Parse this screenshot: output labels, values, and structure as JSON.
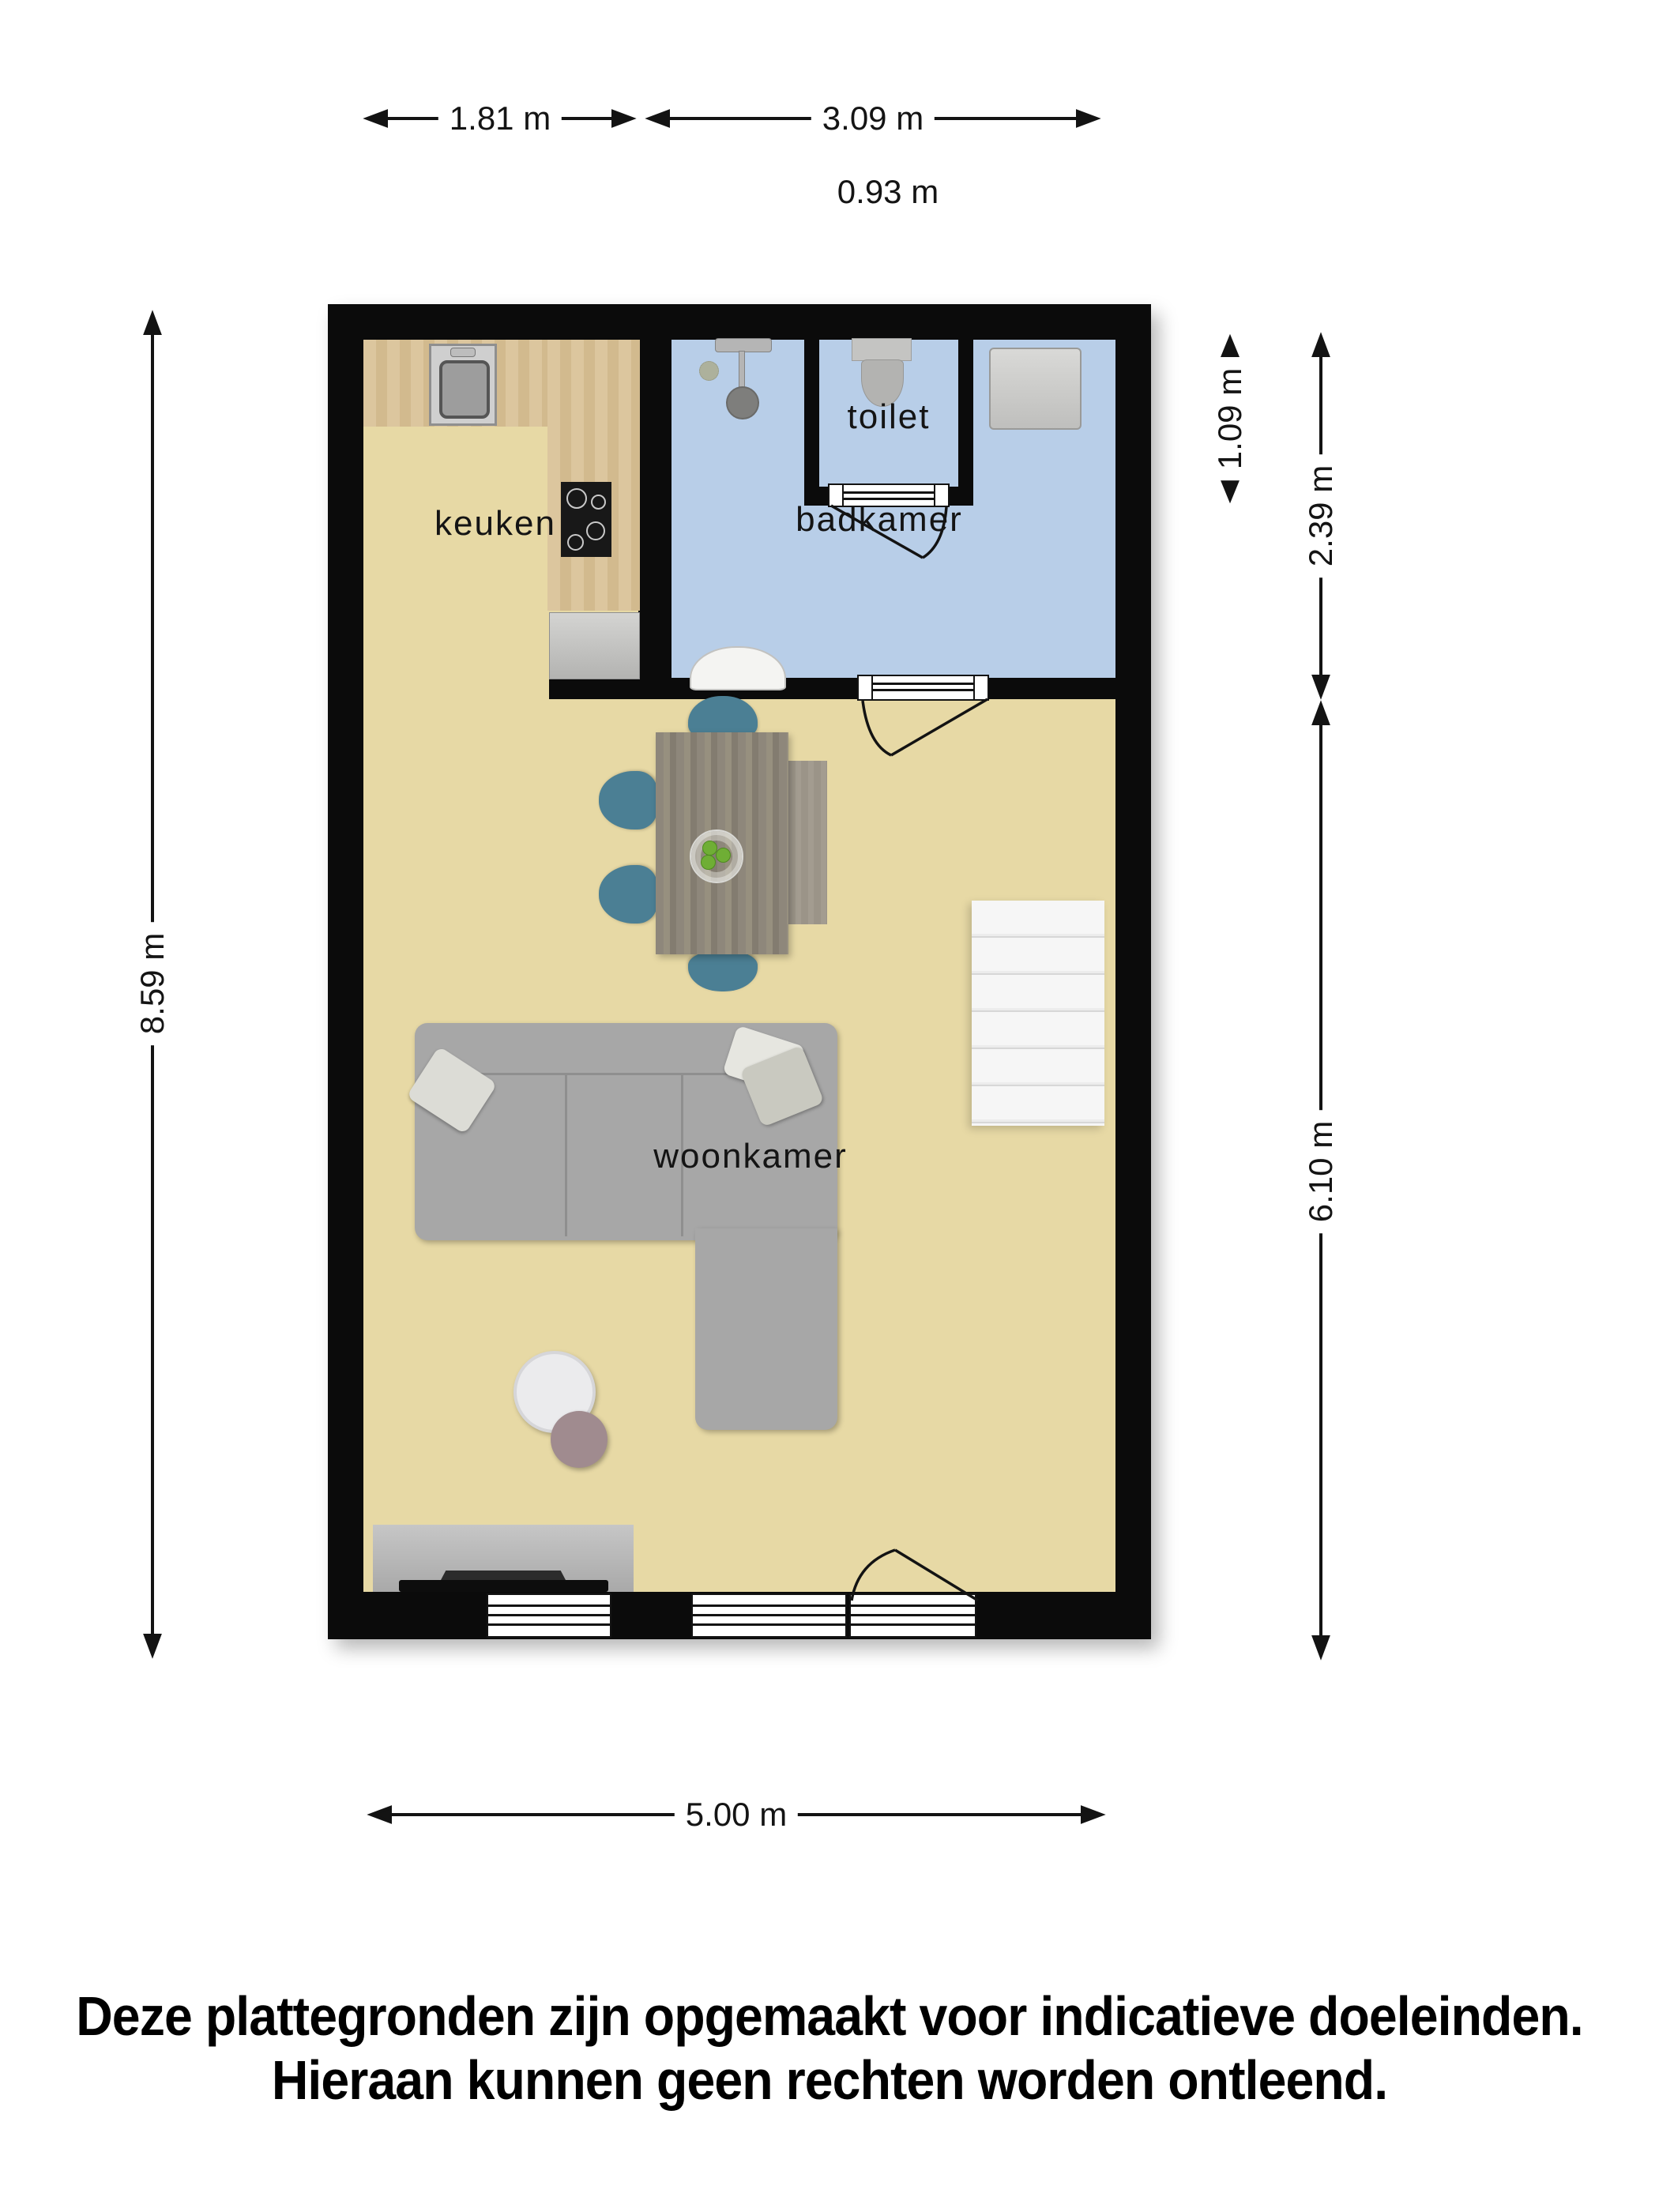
{
  "rooms": {
    "kitchen": {
      "label": "keuken"
    },
    "toilet": {
      "label": "toilet"
    },
    "bathroom": {
      "label": "badkamer"
    },
    "living": {
      "label": "woonkamer"
    }
  },
  "dimensions": {
    "kitchen_width": "1.81 m",
    "bathroom_width": "3.09 m",
    "toilet_width": "0.93 m",
    "total_depth": "8.59 m",
    "toilet_depth": "1.09 m",
    "bathroom_depth": "2.39 m",
    "living_depth": "6.10 m",
    "living_width": "5.00 m"
  },
  "disclaimer": {
    "line1": "Deze plattegronden zijn opgemaakt voor indicatieve doeleinden.",
    "line2": "Hieraan kunnen geen rechten worden ontleend."
  },
  "colors": {
    "wall": "#0b0b0b",
    "floor": "#e7d9a5",
    "bath": "#b8cee8",
    "wood": "#dcc69e",
    "woodDark": "#d2ba8e",
    "gray": "#a7a7a7",
    "teal": "#4b7f94",
    "table": "#8e877b",
    "stairs": "#f4f4f4",
    "green": "#6fae35",
    "mauve": "#a08b8f"
  }
}
